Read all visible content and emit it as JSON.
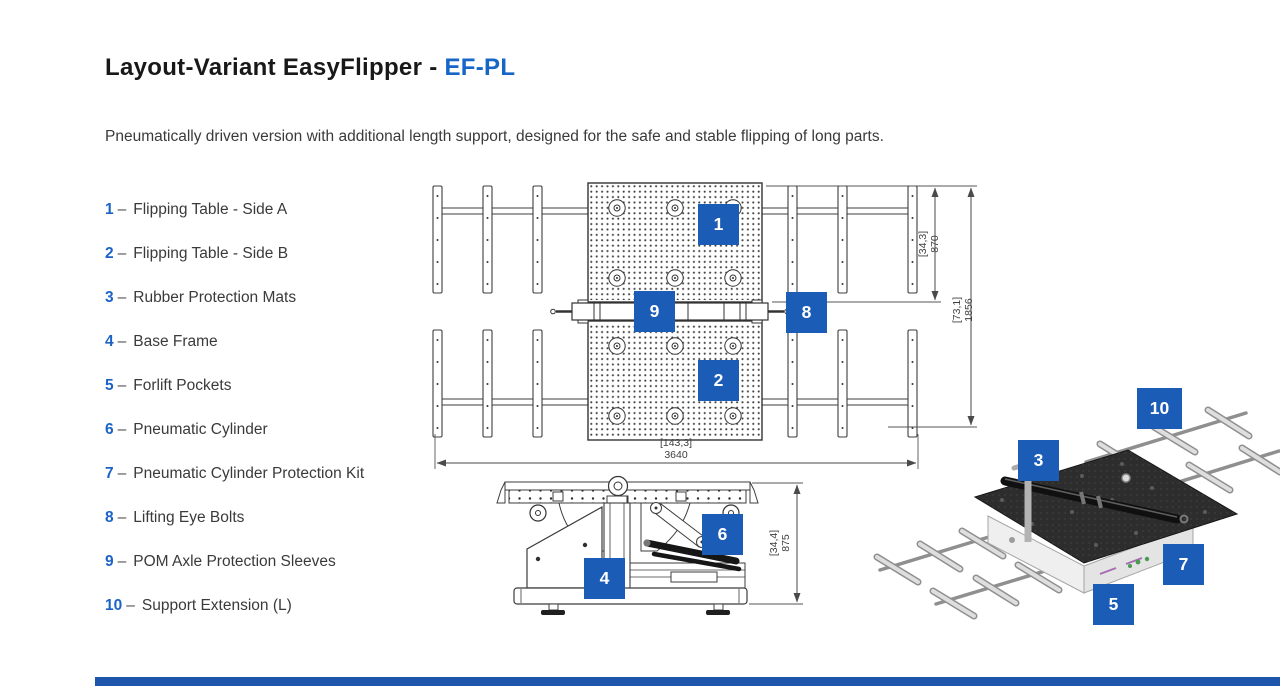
{
  "header": {
    "title_main": "Layout-Variant EasyFlipper - ",
    "title_accent": "EF-PL",
    "subtitle": "Pneumatically driven version with additional length support, designed for the safe and stable flipping of long parts."
  },
  "parts_list": {
    "separator": "–",
    "items": [
      {
        "num": "1",
        "label": "Flipping Table - Side A"
      },
      {
        "num": "2",
        "label": "Flipping Table - Side B"
      },
      {
        "num": "3",
        "label": "Rubber Protection Mats"
      },
      {
        "num": "4",
        "label": "Base Frame"
      },
      {
        "num": "5",
        "label": "Forlift Pockets"
      },
      {
        "num": "6",
        "label": "Pneumatic Cylinder"
      },
      {
        "num": "7",
        "label": "Pneumatic Cylinder Protection Kit"
      },
      {
        "num": "8",
        "label": "Lifting Eye Bolts"
      },
      {
        "num": "9",
        "label": "POM Axle Protection Sleeves"
      },
      {
        "num": "10",
        "label": "Support Extension (L)"
      }
    ]
  },
  "figure": {
    "callouts": [
      {
        "num": "1"
      },
      {
        "num": "2"
      },
      {
        "num": "3"
      },
      {
        "num": "4"
      },
      {
        "num": "5"
      },
      {
        "num": "6"
      },
      {
        "num": "7"
      },
      {
        "num": "8"
      },
      {
        "num": "9"
      },
      {
        "num": "10"
      }
    ],
    "dimensions": {
      "plan_half_depth": {
        "bracket": "[34,3]",
        "value": "870"
      },
      "plan_full_depth": {
        "bracket": "[73,1]",
        "value": "1856"
      },
      "plan_width": {
        "bracket": "[143,3]",
        "value": "3640"
      },
      "side_height": {
        "bracket": "[34,4]",
        "value": "875"
      }
    }
  },
  "colors": {
    "accent": "#1566c6",
    "badge": "#1b5cb7",
    "footer": "#1d56ab"
  }
}
